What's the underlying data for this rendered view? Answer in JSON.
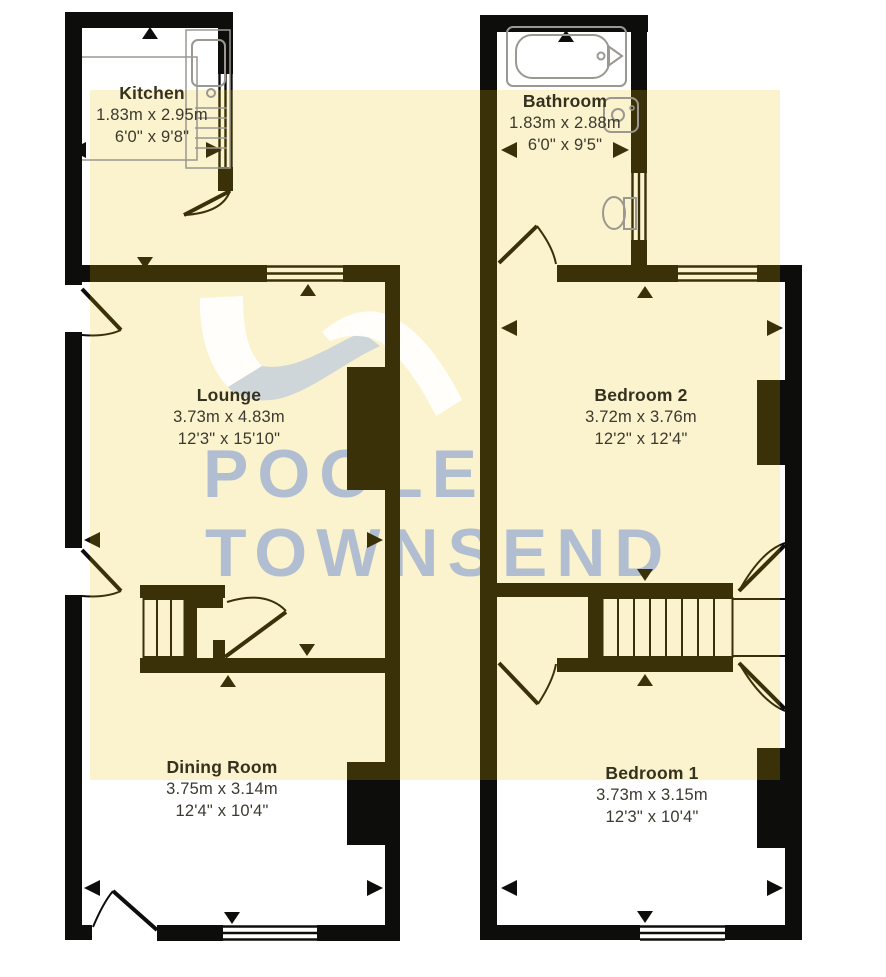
{
  "watermark": {
    "line1": "POOLE",
    "line2": "TOWNSEND"
  },
  "rooms": [
    {
      "name": "Kitchen",
      "metric": "1.83m x 2.95m",
      "imperial": "6'0\" x 9'8\""
    },
    {
      "name": "Bathroom",
      "metric": "1.83m x 2.88m",
      "imperial": "6'0\" x 9'5\""
    },
    {
      "name": "Lounge",
      "metric": "3.73m x 4.83m",
      "imperial": "12'3\" x 15'10\""
    },
    {
      "name": "Bedroom 2",
      "metric": "3.72m x 3.76m",
      "imperial": "12'2\" x 12'4\""
    },
    {
      "name": "Dining Room",
      "metric": "3.75m x 3.14m",
      "imperial": "12'4\" x 10'4\""
    },
    {
      "name": "Bedroom 1",
      "metric": "3.73m x 3.15m",
      "imperial": "12'3\" x 10'4\""
    }
  ],
  "colors": {
    "highlight_cream": "#FBF3CD",
    "wall_black": "#0D0D0C",
    "wall_olive": "#3A3108",
    "watermark_blue": "#AEBCD2",
    "fixture_gray": "#9A9890"
  }
}
